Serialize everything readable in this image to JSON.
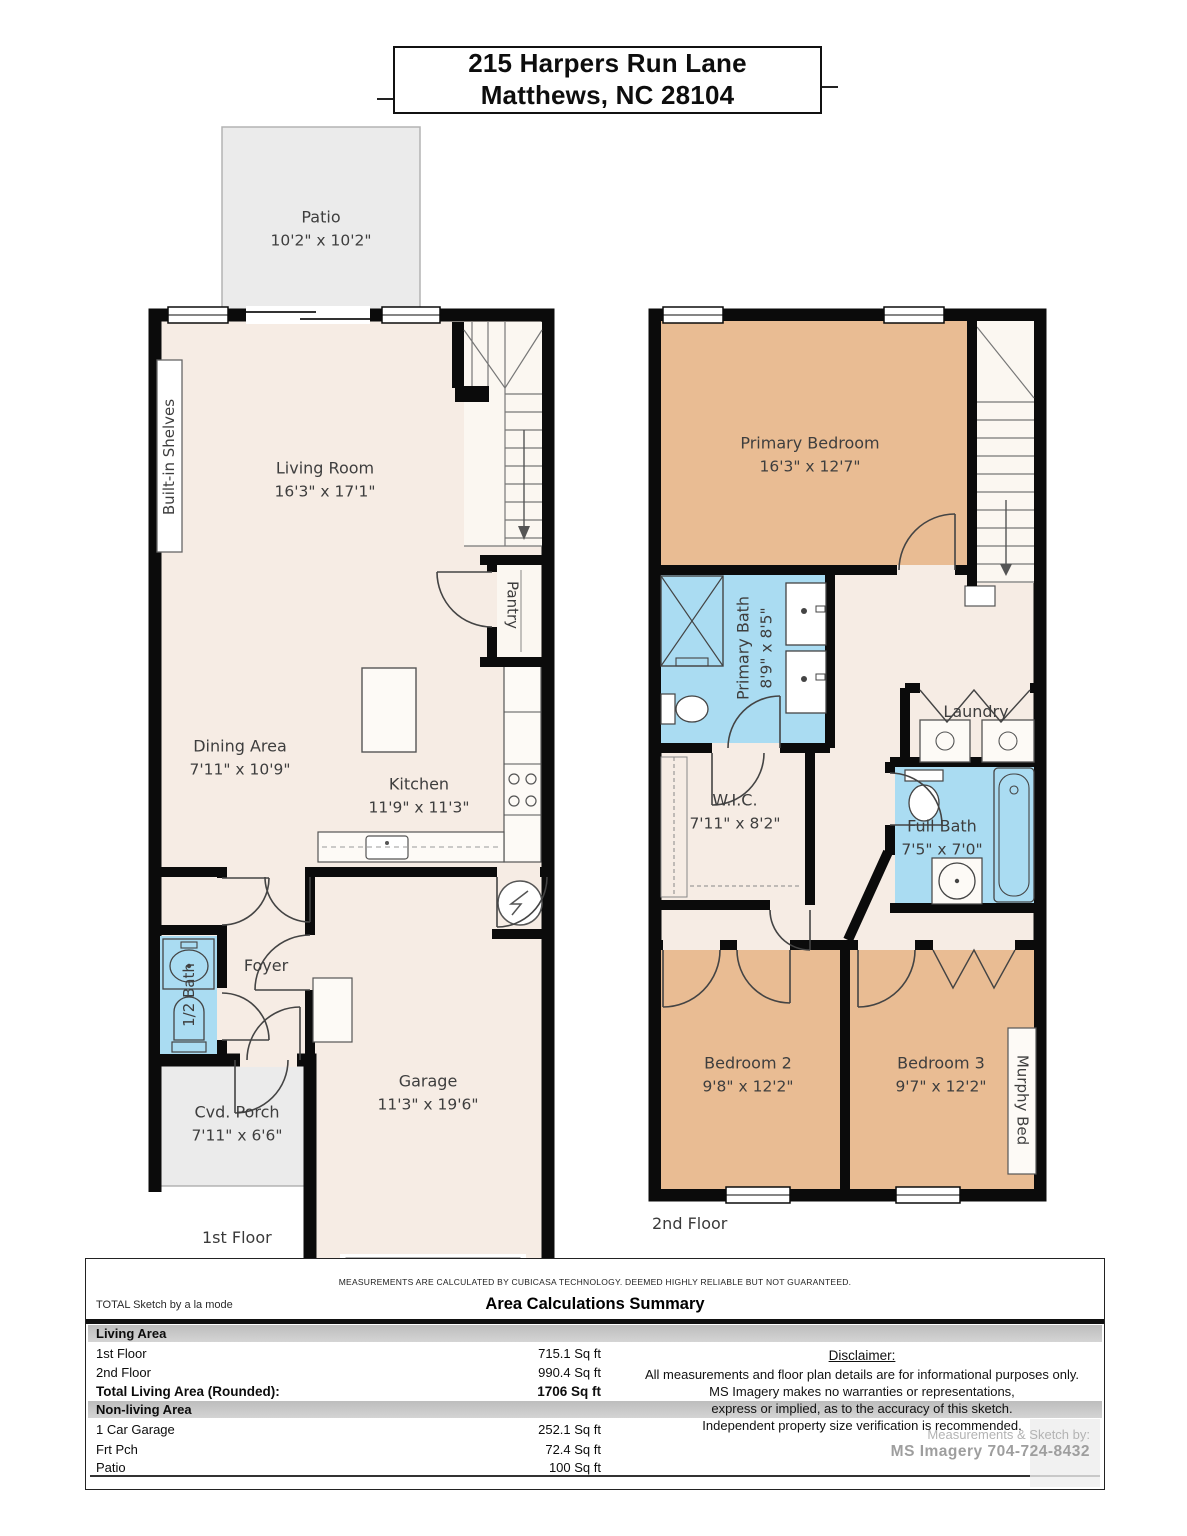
{
  "title": {
    "line1": "215 Harpers Run Lane",
    "line2": "Matthews, NC 28104"
  },
  "floor1": {
    "label": "1st Floor",
    "patio_name": "Patio",
    "patio_dims": "10'2\" x 10'2\"",
    "living_name": "Living Room",
    "living_dims": "16'3\" x 17'1\"",
    "builtin": "Built-in Shelves",
    "pantry": "Pantry",
    "dining_name": "Dining Area",
    "dining_dims": "7'11\" x 10'9\"",
    "kitchen_name": "Kitchen",
    "kitchen_dims": "11'9\" x 11'3\"",
    "foyer": "Foyer",
    "halfbath": "1/2 Bath",
    "porch_name": "Cvd. Porch",
    "porch_dims": "7'11\" x 6'6\"",
    "garage_name": "Garage",
    "garage_dims": "11'3\" x 19'6\""
  },
  "floor2": {
    "label": "2nd Floor",
    "primary_name": "Primary Bedroom",
    "primary_dims": "16'3\" x 12'7\"",
    "pbath_name": "Primary Bath",
    "pbath_dims": "8'9\" x 8'5\"",
    "wic_name": "W.I.C.",
    "wic_dims": "7'11\" x 8'2\"",
    "laundry": "Laundry",
    "fullbath_name": "Full Bath",
    "fullbath_dims": "7'5\" x 7'0\"",
    "bed2_name": "Bedroom 2",
    "bed2_dims": "9'8\" x 12'2\"",
    "bed3_name": "Bedroom 3",
    "bed3_dims": "9'7\" x 12'2\"",
    "murphy": "Murphy Bed"
  },
  "footer": {
    "measurements_note": "MEASUREMENTS ARE CALCULATED BY CUBICASA TECHNOLOGY. DEEMED HIGHLY RELIABLE BUT NOT GUARANTEED.",
    "brand": "TOTAL Sketch by a la mode",
    "summary_title": "Area Calculations Summary",
    "sections": [
      {
        "header": "Living Area",
        "rows": [
          {
            "label": "1st Floor",
            "value": "715.1 Sq ft"
          },
          {
            "label": "2nd Floor",
            "value": "990.4 Sq ft"
          },
          {
            "label": "Total Living Area (Rounded):",
            "value": "1706 Sq ft"
          }
        ]
      },
      {
        "header": "Non-living Area",
        "rows": [
          {
            "label": "1 Car Garage",
            "value": "252.1 Sq ft"
          },
          {
            "label": "Frt Pch",
            "value": "72.4 Sq ft"
          },
          {
            "label": "Patio",
            "value": "100 Sq ft"
          }
        ]
      }
    ],
    "disclaimer": {
      "title": "Disclaimer:",
      "lines": [
        "All measurements and floor plan details are for informational purposes only.",
        "MS Imagery makes no warranties or representations,",
        "express or implied, as to the accuracy of this sketch.",
        "Independent property size verification is recommended."
      ],
      "credit_label": "Measurements & Sketch by:",
      "credit_name": "MS Imagery  704-724-8432"
    }
  },
  "colors": {
    "wall": "#0b0b0b",
    "floor": "#f6ece4",
    "bedroom": "#e9bc93",
    "bath": "#aadcf2",
    "outdoor": "#ebebeb"
  }
}
